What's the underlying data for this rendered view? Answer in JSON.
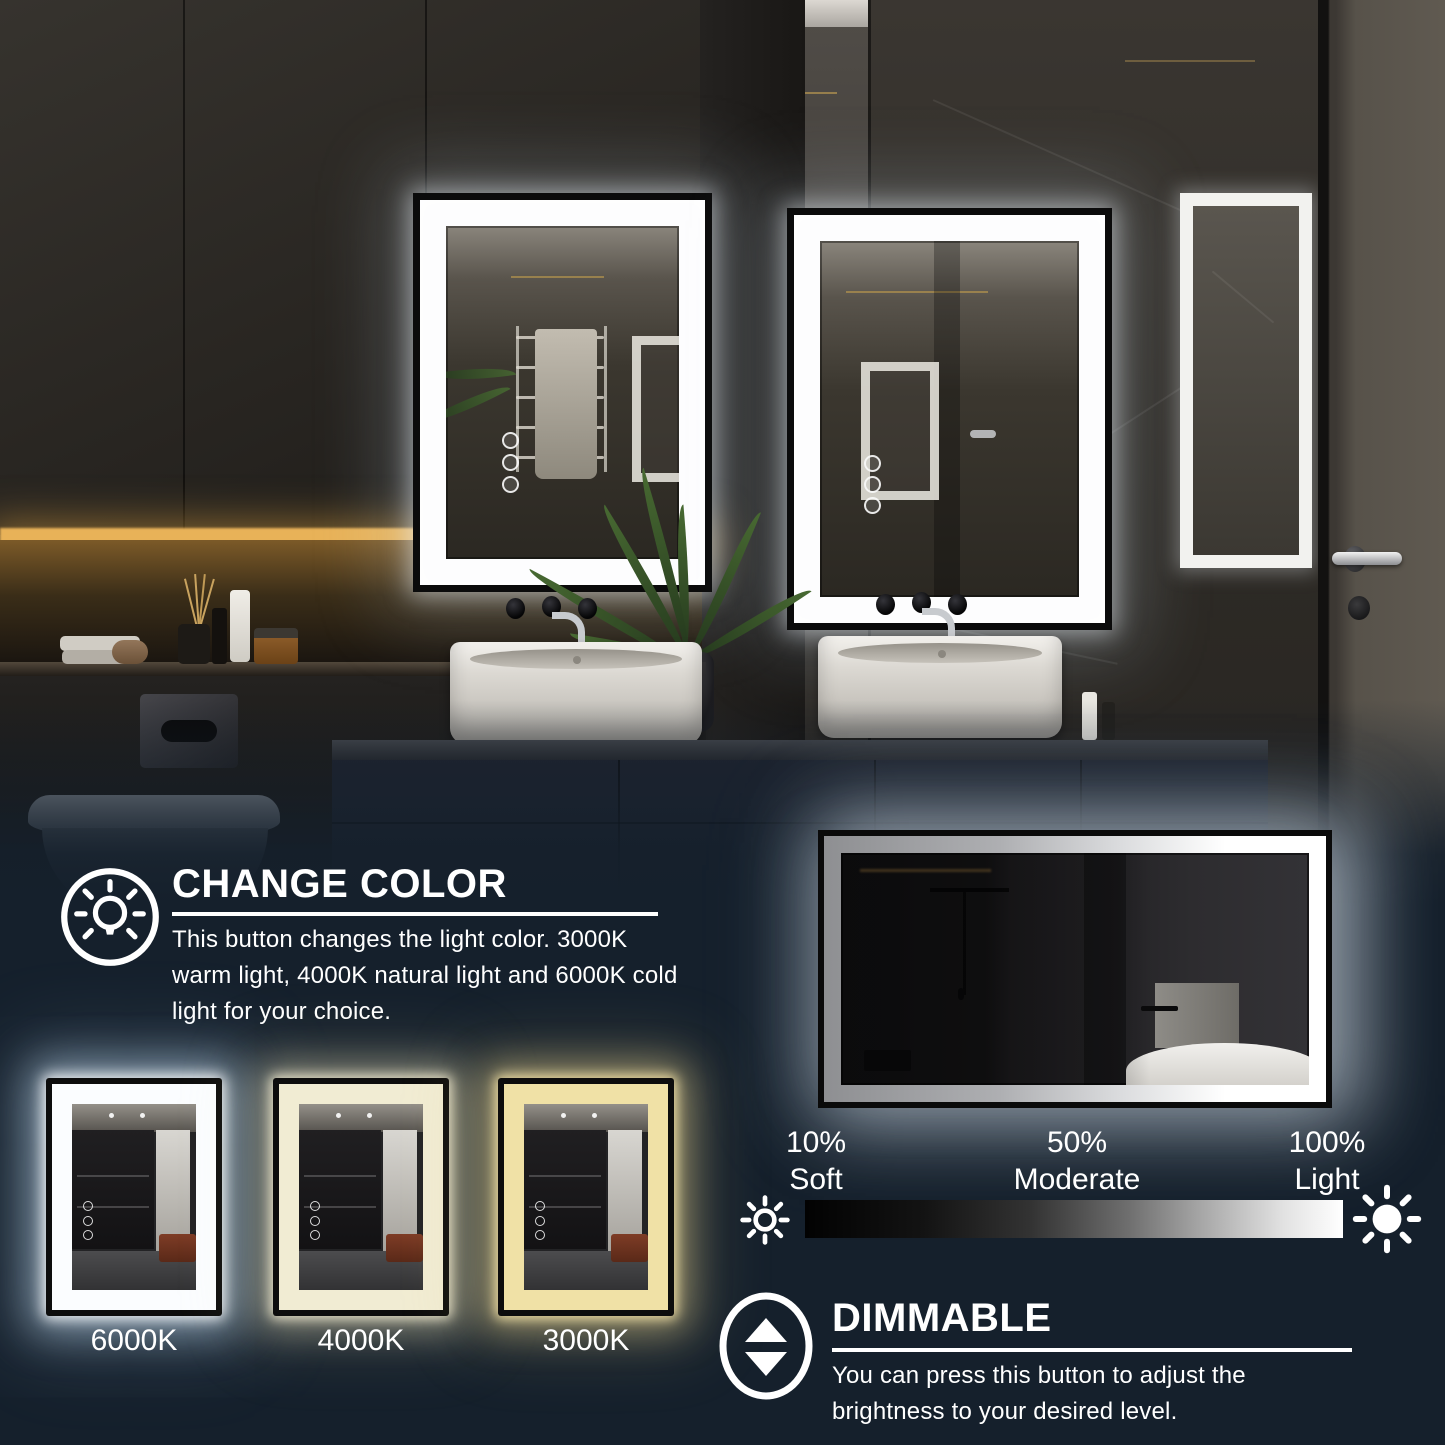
{
  "theme": {
    "overlay_navy": "#15202c",
    "text_white": "#ffffff",
    "gold_inlay": "#a3884e",
    "warm_shelf_glow": "#e8b258",
    "brightness_bar_start": "#000000",
    "brightness_bar_end": "#ffffff"
  },
  "change_color": {
    "icon": "light-bulb-rays-icon",
    "title": "CHANGE COLOR",
    "description": "This button changes the light color. 3000K warm light, 4000K natural light and 6000K cold light for your choice."
  },
  "color_temperatures": [
    {
      "label": "6000K",
      "name": "cold-light",
      "led_color": "#fbfdff",
      "glow_color": "#cbe3f8"
    },
    {
      "label": "4000K",
      "name": "natural-light",
      "led_color": "#f1ecd3",
      "glow_color": "#eee4bc"
    },
    {
      "label": "3000K",
      "name": "warm-light",
      "led_color": "#f0e1a6",
      "glow_color": "#eed894"
    }
  ],
  "brightness": {
    "low_icon": "sun-outline-icon",
    "high_icon": "sun-filled-icon",
    "levels": [
      {
        "percent": "10%",
        "label": "Soft"
      },
      {
        "percent": "50%",
        "label": "Moderate"
      },
      {
        "percent": "100%",
        "label": "Light"
      }
    ]
  },
  "dimmable": {
    "icon": "up-down-arrows-icon",
    "title": "DIMMABLE",
    "description": "You can press this button to adjust the brightness to your desired level."
  }
}
